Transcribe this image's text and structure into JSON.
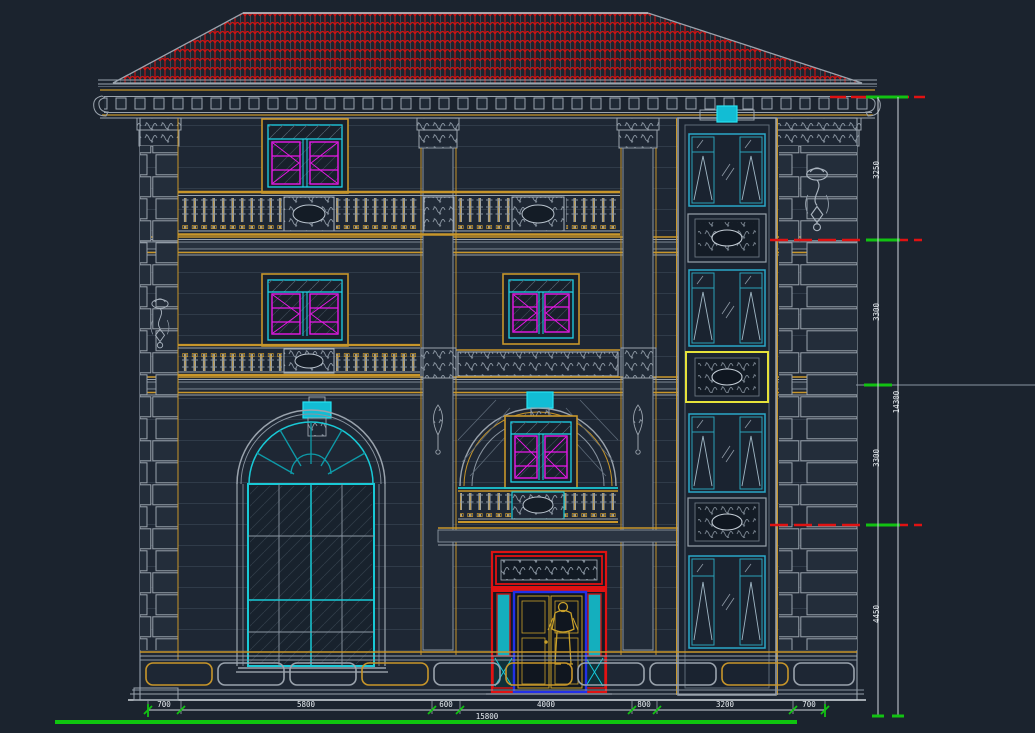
{
  "palette": {
    "background": "#1b232e",
    "line_gray": "#9aa3ad",
    "gold": "#c8962a",
    "roof_red": "#cf1212",
    "level_red": "#e01212",
    "cyan": "#1fd3e8",
    "teal": "#2ba8c8",
    "magenta": "#e818e8",
    "dim_green": "#12c212",
    "door_blue": "#2230e8",
    "panel_yellow": "#e6e23a"
  },
  "dimensions": {
    "right": {
      "segments": [
        "3250",
        "3300",
        "3300",
        "4450"
      ],
      "overall": "14300"
    },
    "bottom": {
      "segments": [
        "700",
        "5800",
        "600",
        "4000",
        "800",
        "3200",
        "700"
      ],
      "overall": "15800"
    }
  }
}
